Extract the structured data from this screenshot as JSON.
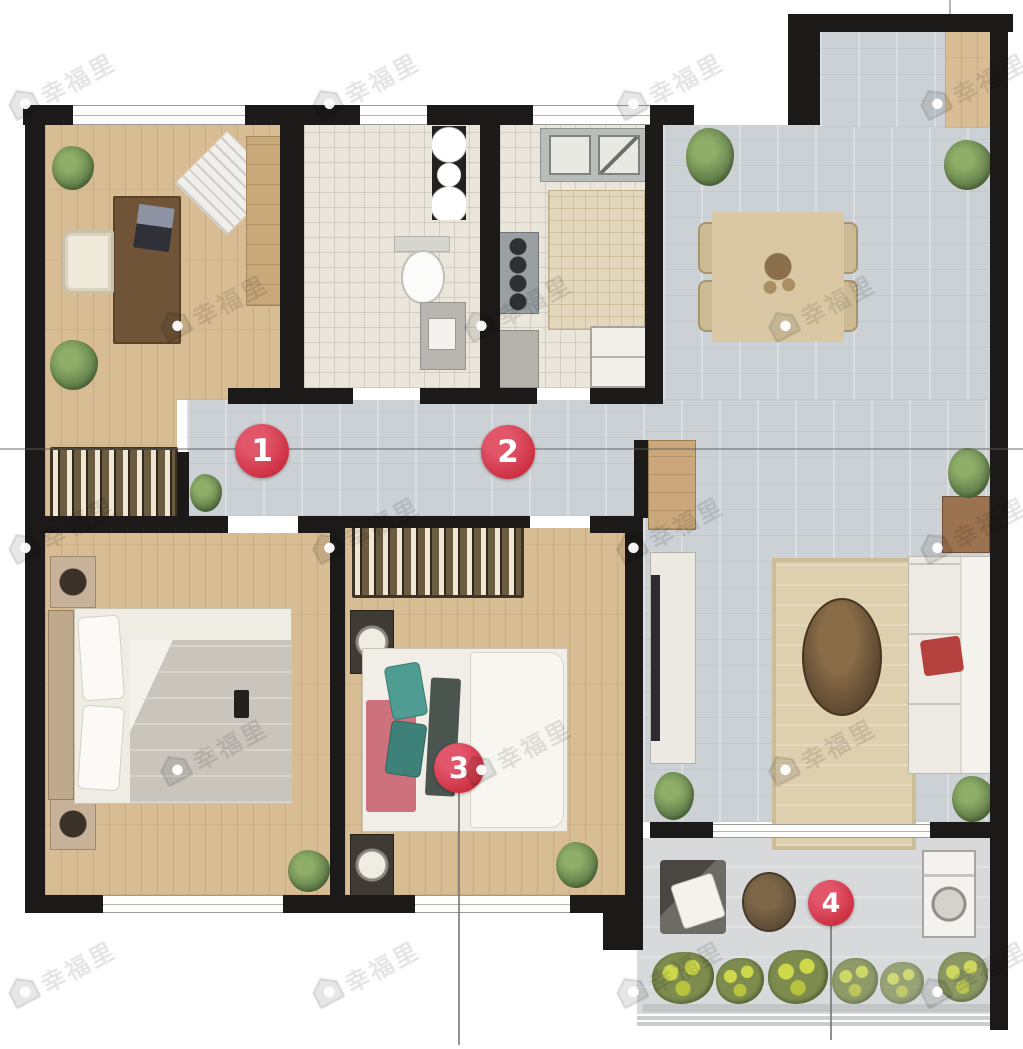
{
  "meta": {
    "type": "apartment-floor-plan",
    "description": "furnished residential floor plan with numbered annotation hotspots"
  },
  "watermark": {
    "text": "幸福里",
    "icon": "house-badge-icon",
    "rows": [
      {
        "y": 85,
        "xs": [
          62,
          366,
          670,
          974
        ]
      },
      {
        "y": 307,
        "xs": [
          214,
          518,
          822
        ]
      },
      {
        "y": 529,
        "xs": [
          62,
          366,
          670,
          974
        ]
      },
      {
        "y": 751,
        "xs": [
          214,
          518,
          822
        ]
      },
      {
        "y": 973,
        "xs": [
          62,
          366,
          670,
          974
        ]
      }
    ]
  },
  "markers": [
    {
      "id": "marker-1",
      "label": "1",
      "x": 262,
      "y": 451,
      "r": 27,
      "leader_to_y": null
    },
    {
      "id": "marker-2",
      "label": "2",
      "x": 508,
      "y": 452,
      "r": 27,
      "leader_to_y": null
    },
    {
      "id": "marker-3",
      "label": "3",
      "x": 459,
      "y": 768,
      "r": 25,
      "leader_to_y": 1045
    },
    {
      "id": "marker-4",
      "label": "4",
      "x": 831,
      "y": 903,
      "r": 23,
      "leader_to_y": 1040
    }
  ],
  "rooms": [
    {
      "id": "study",
      "floor": "wood"
    },
    {
      "id": "bathroom",
      "floor": "tile"
    },
    {
      "id": "kitchen",
      "floor": "tile"
    },
    {
      "id": "dining-area",
      "floor": "gray-tile"
    },
    {
      "id": "hallway",
      "floor": "gray-tile"
    },
    {
      "id": "walk-in-closet",
      "floor": "wood"
    },
    {
      "id": "master-bedroom",
      "floor": "wood"
    },
    {
      "id": "second-bedroom",
      "floor": "wood"
    },
    {
      "id": "living-room",
      "floor": "gray-tile"
    },
    {
      "id": "balcony",
      "floor": "gray-tile"
    }
  ],
  "palette": {
    "accent_red": "#cc2f40",
    "wall_black": "#1c1a18",
    "wood_floor": "#d8bc93",
    "tile_light": "#eae6db",
    "tile_gray": "#ccd1d5",
    "balcony_gray": "#d7d9da",
    "dark_wood": "#6f5438",
    "dining_beige": "#d9c8a3",
    "plant_green": "#6d8a52",
    "teal_pillow": "#4e9c92",
    "sofa_cushion_red": "#b5413f",
    "watermark_gray": "rgba(0,0,0,0.10)"
  }
}
